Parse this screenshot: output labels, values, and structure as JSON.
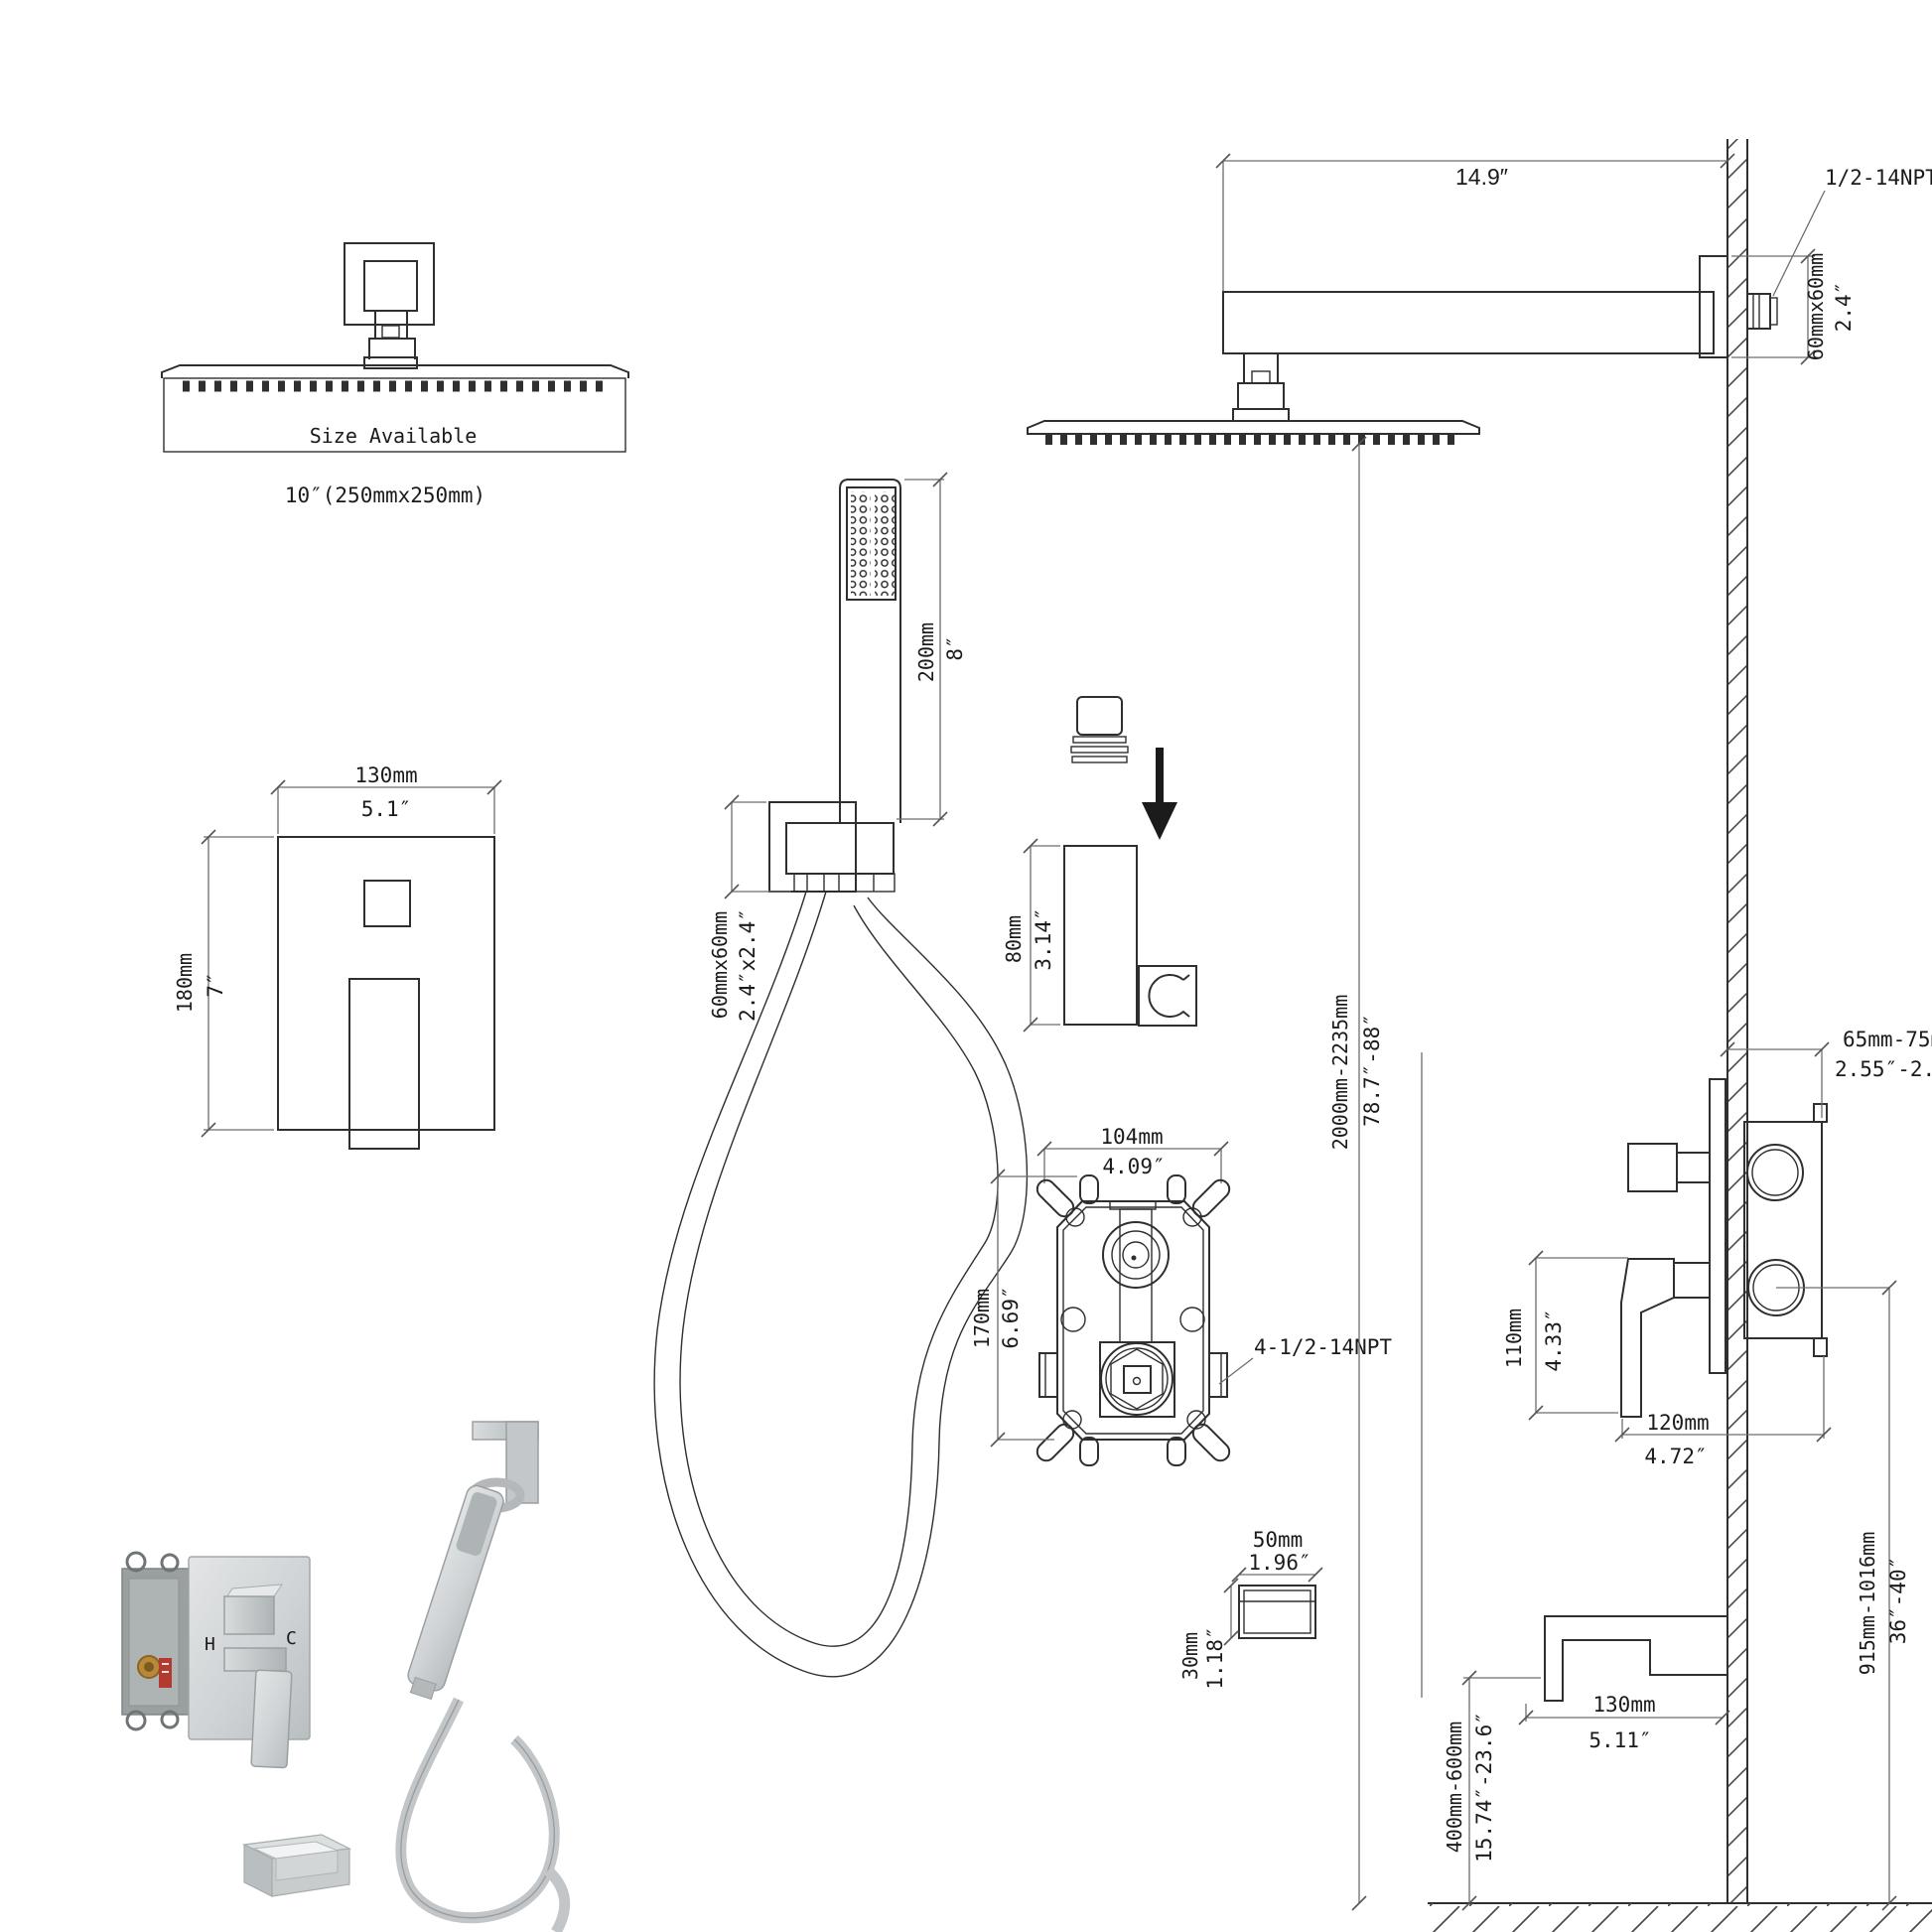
{
  "colors": {
    "line": "#2f2f2f",
    "dim": "#6e6e6e",
    "text": "#1b1b1b",
    "hot": "#b03a30",
    "cold": "#3b76c4"
  },
  "overhead_head": {
    "note": "Size Available",
    "size": "10″(250mmx250mm)"
  },
  "wall_head": {
    "arm_length_in": "14.9″",
    "thread": "1/2-14NPT",
    "flange_mm": "60mmx60mm",
    "flange_in": "2.4″"
  },
  "trim_front": {
    "width_mm": "130mm",
    "width_in": "5.1″",
    "height_mm": "180mm",
    "height_in": "7″"
  },
  "handheld": {
    "length_mm": "200mm",
    "length_in": "8″",
    "outlet_mm": "60mmx60mm",
    "outlet_in": "2.4″x2.4″"
  },
  "holder": {
    "height_mm": "80mm",
    "height_in": "3.14″"
  },
  "rough_valve": {
    "width_mm": "104mm",
    "width_in": "4.09″",
    "height_mm": "170mm",
    "height_in": "6.69″",
    "ports": "4-1/2-14NPT"
  },
  "install_heights": {
    "head_mm": "2000mm-2235mm",
    "head_in": "78.7″-88″",
    "valve_mm": "915mm-1016mm",
    "valve_in": "36″-40″",
    "spout_mm": "400mm-600mm",
    "spout_in": "15.74″-23.6″"
  },
  "side_valve": {
    "depth_mm": "65mm-75mm",
    "depth_in": "2.55″-2.95″",
    "handle_mm": "110mm",
    "handle_in": "4.33″",
    "clear_mm": "120mm",
    "clear_in": "4.72″"
  },
  "spout": {
    "length_mm": "130mm",
    "length_in": "5.11″"
  },
  "escutcheon": {
    "width_mm": "50mm",
    "width_in": "1.96″",
    "height_mm": "30mm",
    "height_in": "1.18″"
  },
  "photo": {
    "hot": "H",
    "cold": "C"
  }
}
